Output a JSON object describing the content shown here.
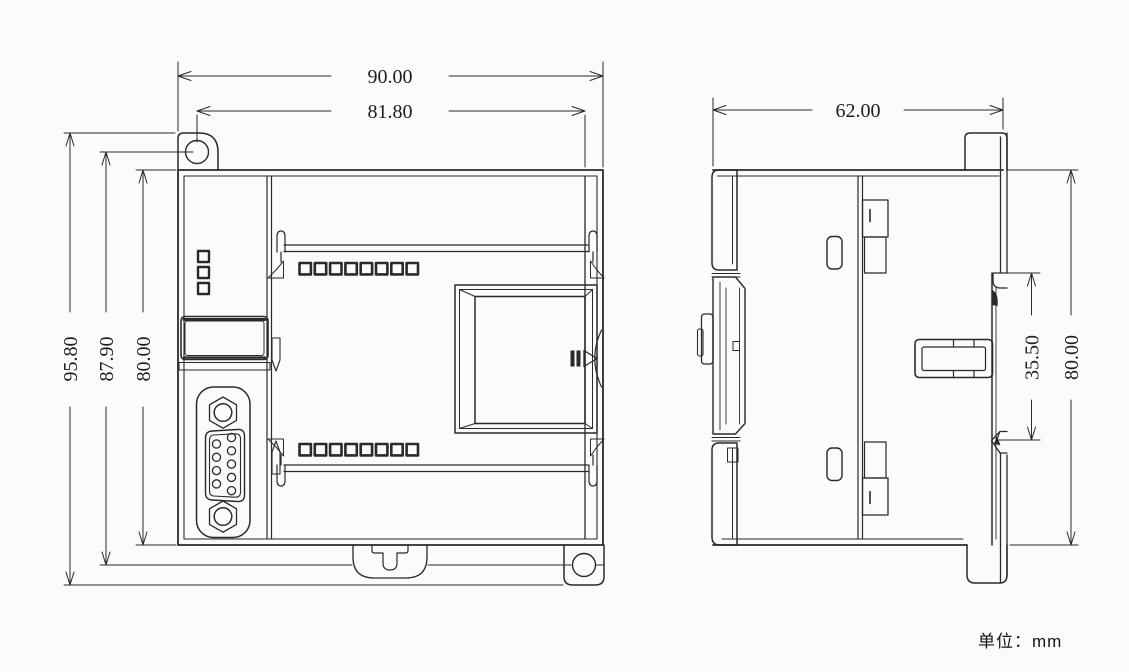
{
  "page": {
    "background": "#fbfbfb",
    "line_color": "#2a2a2a",
    "text_color": "#1d1d1d"
  },
  "unit_note": "单位：mm",
  "views": {
    "front": {
      "label": "front-view",
      "dimensions": {
        "overall_width": "90.00",
        "mounting_hole_spacing_x": "81.80",
        "overall_height": "95.80",
        "mounting_hole_spacing_y": "87.90",
        "body_height": "80.00"
      },
      "features": {
        "top_indicator_count": 8,
        "bottom_indicator_count": 8,
        "status_indicator_count": 3,
        "db9_hole_count": 9,
        "mounting_hole_count": 2
      }
    },
    "side": {
      "label": "side-view",
      "dimensions": {
        "overall_depth": "62.00",
        "din_rail_opening": "35.50",
        "body_height": "80.00"
      }
    }
  }
}
